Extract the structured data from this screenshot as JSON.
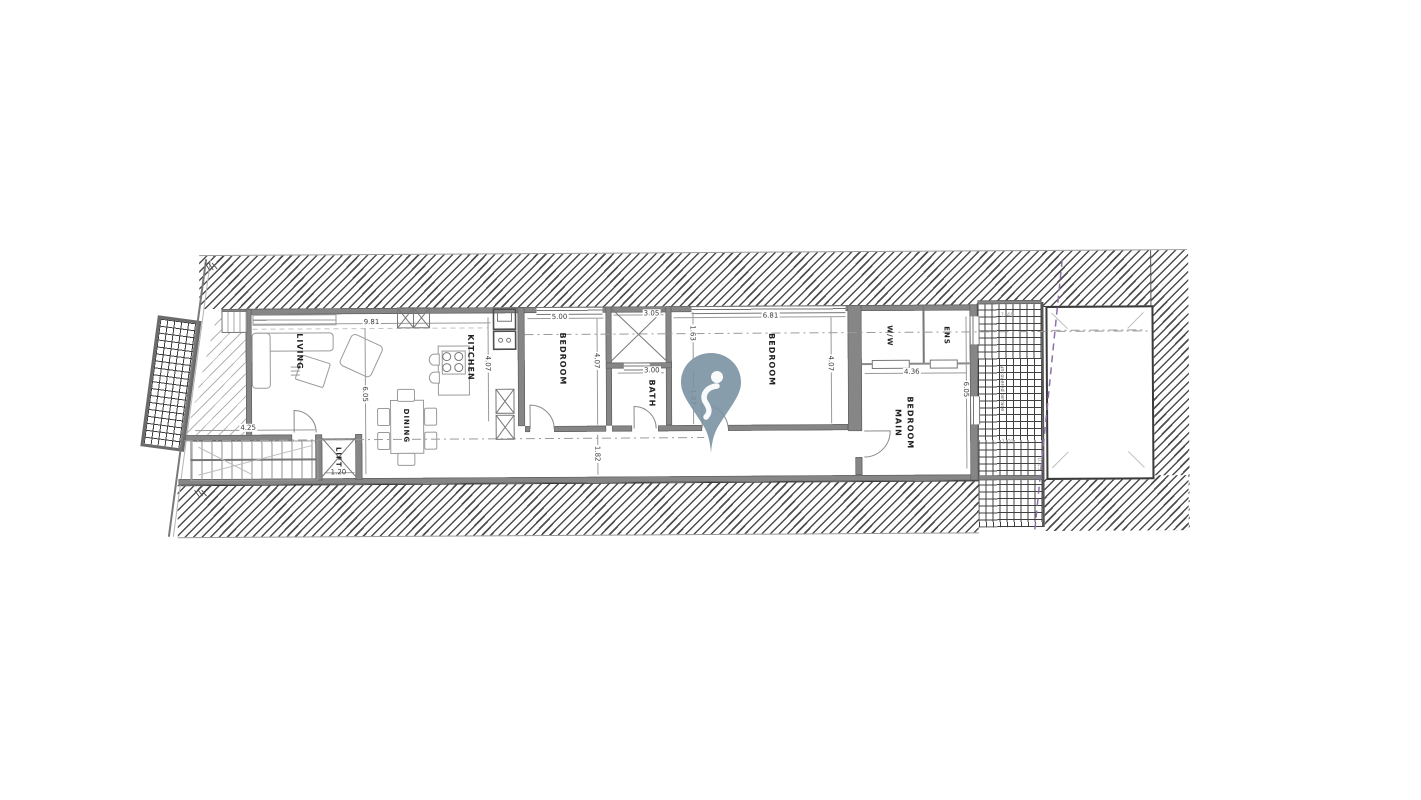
{
  "plan": {
    "rooms": {
      "living": "LIVING",
      "dining": "DINING",
      "kitchen": "KITCHEN",
      "bedroom1": "BEDROOM",
      "bath": "BATH",
      "bedroom2": "BEDROOM",
      "main_bedroom_line1": "MAIN",
      "main_bedroom_line2": "BEDROOM",
      "ww": "W/W",
      "ens": "ENS",
      "lift": "LIFT"
    },
    "notes": {
      "yard": "uncovered terrace"
    },
    "dimensions": {
      "living_width": "9.81",
      "living_depth": "6.05",
      "kitchen_depth": "4.07",
      "bedroom1_width": "5.00",
      "bedroom1_depth": "4.07",
      "shaft_width": "3.05",
      "shaft_depth": "1.63",
      "bath_width": "3.00",
      "bath_depth": "1.87",
      "bedroom2_width": "6.81",
      "bedroom2_depth": "4.07",
      "corridor_width": "1.82",
      "stairs_width": "4.25",
      "lift_width": "1.20",
      "main_bedroom_width": "4.36",
      "main_bedroom_depth": "6.05",
      "yard_width": "1.40",
      "yard_inner": "1.25",
      "yard_offset": "0.15"
    },
    "colors": {
      "wall": "#868686",
      "hatch": "#4d4d4d",
      "boundary_line": "#8f6fa8",
      "watermark_pin": "#7a92a3"
    }
  }
}
